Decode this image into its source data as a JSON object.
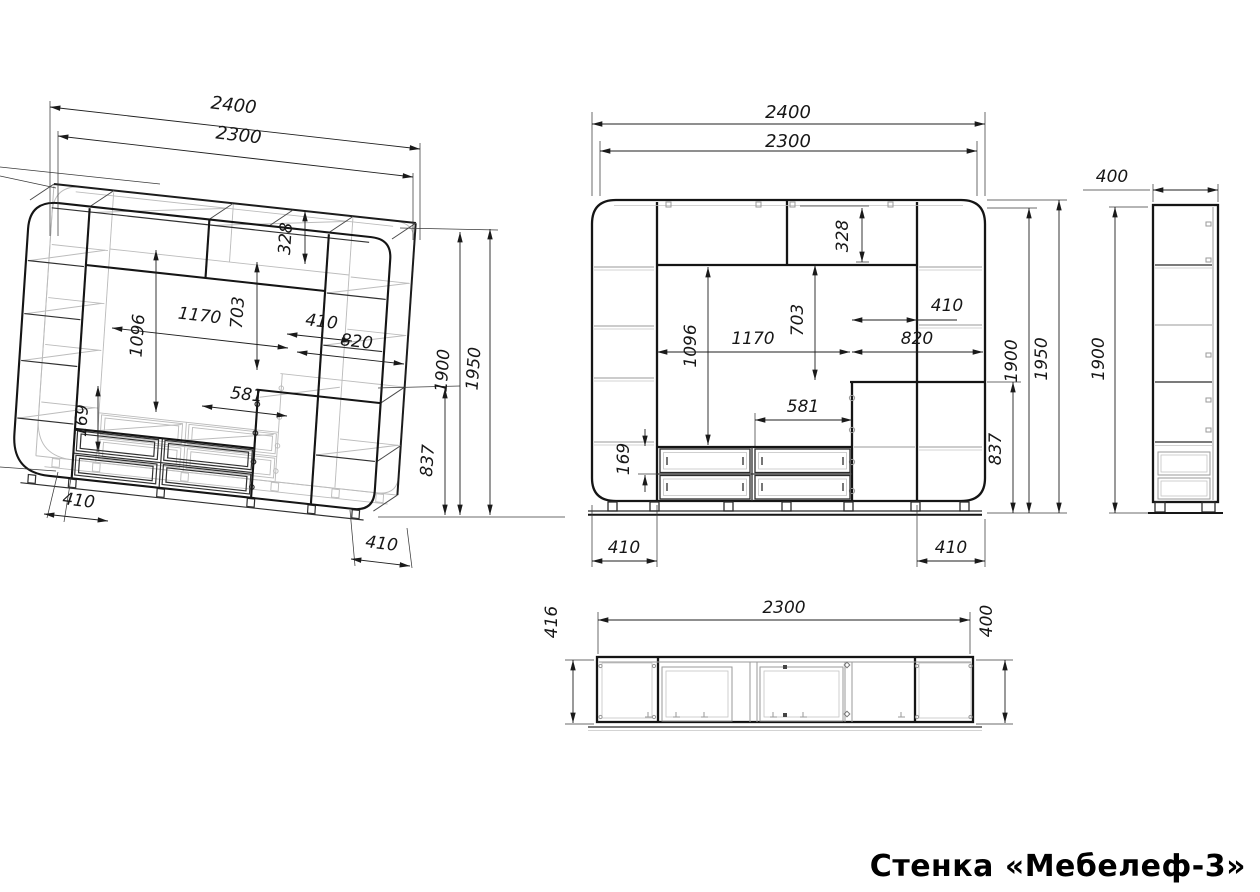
{
  "title": "Стенка «Мебелеф-3»",
  "views": {
    "iso": {
      "dims": {
        "total_width": "2400",
        "inner_width": "2300",
        "top_section_height": "328",
        "tv_height": "1096",
        "tv_width": "1170",
        "niche_height": "703",
        "shelf_width": "410",
        "block_width": "820",
        "drawer_width": "581",
        "drawer_height": "169",
        "lower_height": "837",
        "body_height": "1900",
        "total_height": "1950",
        "base_left": "410",
        "base_right": "410"
      }
    },
    "front": {
      "dims": {
        "total_width": "2400",
        "inner_width": "2300",
        "top_section_height": "328",
        "tv_height": "1096",
        "tv_width": "1170",
        "niche_height": "703",
        "shelf_width": "410",
        "block_width": "820",
        "drawer_width": "581",
        "drawer_height": "169",
        "lower_height": "837",
        "body_height": "1900",
        "total_height": "1950",
        "base_left": "410",
        "base_right": "410"
      }
    },
    "side": {
      "dims": {
        "depth": "400",
        "height": "1900"
      }
    },
    "top": {
      "dims": {
        "depth_left": "416",
        "width": "2300",
        "depth_right": "400"
      }
    }
  }
}
